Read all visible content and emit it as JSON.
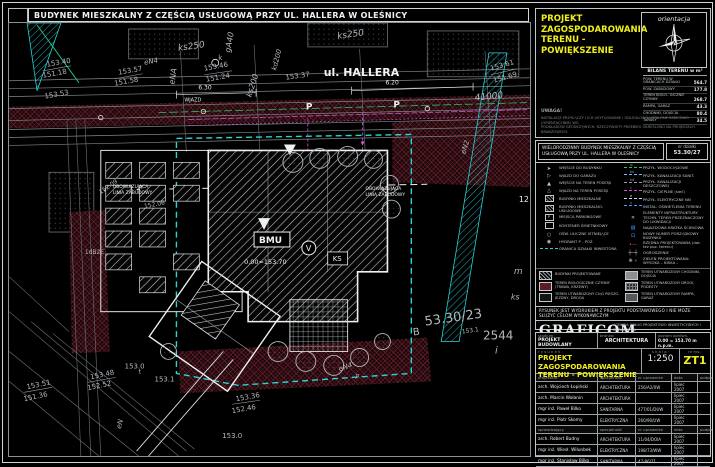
{
  "sheet_title": "BUDYNEK MIESZKALNY  Z CZĘŚCIĄ USŁUGOWĄ PRZY UL. HALLERA W OLEŚNICY",
  "colors": {
    "accent_yellow": "#f0ef1e",
    "boundary_cyan": "#27d3d3",
    "utility_magenta": "#cf53cf",
    "green_line": "#2abf6e",
    "maroon_hatch": "#6e2430"
  },
  "top_right": {
    "drawing_title_line1": "PROJEKT ZAGOSPODAROWANIA",
    "drawing_title_line2": "TERENU - POWIĘKSZENIE",
    "orientation_label": "orientacja",
    "balance": {
      "header": "BILANS TERENU w m²",
      "rows": [
        {
          "label": "POW. TERENU W GRANICACH DZIAŁKI",
          "value": "564.7"
        },
        {
          "label": "POW. ZABUDOWY",
          "value": "177.8"
        },
        {
          "label": "TEREN BIOLO- GICZNIE CZYNNY",
          "value": "268.7"
        },
        {
          "label": "RAMPA, GARAŻ",
          "value": "43.3"
        },
        {
          "label": "CHODNIKI, DOJŚCIA",
          "value": "80.4"
        },
        {
          "label": "TARASY",
          "value": "34.5"
        }
      ]
    },
    "note_title": "UWAGA!",
    "note_line1": "INSTALACJE PRZYŁĄCZY I ICH USYTUOWANIE I ODLEGŁOŚCI USTALONE SZKICOWO (ORIENTACYJNIE) WG",
    "note_line2": "PODKŁADÓW GEODEZYJNYCH. RZECZYWISTY PRZEBIEG OKREŚLONO NA PROJEKTACH BRANŻOWYCH."
  },
  "legend": {
    "header_line1": "WIELORODZINNY BUDYNEK MIESZKALNY Z CZĘŚCIĄ",
    "header_line2": "USŁUGOWĄ PRZY UL. HALLERA W OLEŚNICY",
    "plot_label": "nr działki",
    "plot_number": "53.30/27",
    "left_items": [
      {
        "icon": "arrow-filled",
        "label": "WEJŚCIE DO BUDYNKU"
      },
      {
        "icon": "arrow-open",
        "label": "WJAZD DO GARAŻU"
      },
      {
        "icon": "triangle-filled",
        "label": "WEJŚCIE NA TEREN POSESJI"
      },
      {
        "icon": "triangle-open",
        "label": "WJAZD NA TEREN POSESJI"
      },
      {
        "icon": "square-hatch",
        "label": "BUDYNKI MIESZKALNE"
      },
      {
        "icon": "square-hatch",
        "label": "BUDYNKI MIESZKALNO-USŁUGOWE"
      },
      {
        "icon": "square-p",
        "label": "MIEJSCA PARKINGOWE"
      },
      {
        "icon": "square-open",
        "label": "KONTENER ŚMIETNIKOWY"
      },
      {
        "icon": "circle-lamp",
        "label": "OŚW. ULICZNE ISTNIEJĄCE"
      },
      {
        "icon": "circle-hydrant",
        "label": "HYDRANT P - POŻ."
      },
      {
        "icon": "cyan-dash",
        "label": "GRANICA DZIAŁKI INWESTORA"
      }
    ],
    "right_items": [
      {
        "icon": "line",
        "color": "#2abf6e",
        "tag": "w",
        "label": "PRZYŁ. WODOCIĄGOWE"
      },
      {
        "icon": "line",
        "color": "#6fb7ff",
        "tag": "ks",
        "label": "PRZYŁ. KANALIZACJI SANIT."
      },
      {
        "icon": "line",
        "color": "#9aa0a4",
        "tag": "kd",
        "label": "PRZYŁ. KANALIZACJI DESZCZOWEJ"
      },
      {
        "icon": "line",
        "color": "#cf53cf",
        "tag": "c",
        "label": "PRZYŁ. CIEPLNE (sieć)"
      },
      {
        "icon": "line",
        "color": "#d6dadd",
        "tag": "e",
        "label": "PRZYŁ. ELEKTRYCZNE NN"
      },
      {
        "icon": "line",
        "color": "#3aa0ff",
        "tag": "o",
        "label": "INSTAL. OŚWIETLENIA TERENU"
      },
      {
        "icon": "x-mark",
        "label": "ELEMENTY INFRASTRUKTURY TECHN. TEREN PRZEZNACZONY DO LIKWIDACJI"
      },
      {
        "icon": "grate",
        "label": "NAJAZDOWA KRATKA ŚCIEKOWA"
      },
      {
        "icon": "number",
        "label": "NOWY NUMER PORZĄDKOWY BUDYNKU"
      },
      {
        "icon": "level-mark",
        "label": "RZĘDNA PROJEKTOWANA (dot. też poz. terenu)"
      },
      {
        "icon": "fence",
        "label": "OGRODZENIE"
      },
      {
        "icon": "greenery",
        "label": "ZIELEŃ PROJEKTOWANA:  WYSOKA –   NISKA –"
      }
    ],
    "swatches": [
      {
        "style": "hatch",
        "label": "BUDYNKI PROJEKTOWANE"
      },
      {
        "style": "grey",
        "label": "TEREN UTWARDZONY CHODNIKI, DOJŚCIA"
      },
      {
        "style": "maroon",
        "label": "TEREN BIOLOGICZNIE CZYNNY (TRAWA, KRZEWY)"
      },
      {
        "style": "checker",
        "label": "TEREN UTWARDZONY DROGI, PODESTY"
      },
      {
        "style": "outline",
        "label": "TEREN UTWARDZONY CIĄG PIESZO-JEZDNY, DROGA"
      },
      {
        "style": "dark",
        "label": "TEREN UTWARDZONY RAMPA, GARAŻ"
      }
    ],
    "disclaimer": "RYSUNEK JEST WYDRUKIEM Z PROJEKTU PODSTAWOWEGO I NIE MOŻE SŁUŻYĆ CELOM WYKONAWCZYM",
    "company": {
      "name": "GRAFICOM",
      "sub": "A R C H I T E K T U R A",
      "address_line1": "AGENCJA USŁUG PROJEKTOWO INWESTYCYJNYCH I DORADZTWA",
      "address_line2": "MARCIN WOŁANIN   50-430 WROCŁAW, UL. KRAKOWSKA 76",
      "address_line3": "TEL. 071 78-88-517, 501-783-382, FAX 071 78-88-501"
    }
  },
  "title_block": {
    "stadium_label": "stadium:",
    "stadium": "PROJEKT BUDOWLANY",
    "branza_label": "branża:",
    "branza": "ARCHITEKTURA",
    "level_label": "poziom porówn.",
    "level": "0.00 = 153.70 m n.p.m.",
    "rysunek_label": "r y s u n e k :",
    "drawing_line1": "PROJEKT ZAGOSPODAROWANIA",
    "drawing_line2": "TERENU - POWIĘKSZENIE",
    "scale_label": "s k a l a :",
    "scale": "1:250",
    "number_label": "nr rys.:",
    "number": "ZT1",
    "columns": {
      "designer": "projektant",
      "spec": "specjalność",
      "cert": "nr uprawnień",
      "date": "data",
      "sign": "podpis"
    },
    "checker_label": "sprawdzający",
    "designers": [
      {
        "name": "arch. Wojciech Łopiński",
        "spec": "ARCHITEKTURA",
        "cert": "256/A2/XW",
        "date": "lipiec 2007"
      },
      {
        "name": "arch. Marcin Wołanin",
        "spec": "ARCHITEKTURA",
        "cert": "",
        "date": "lipiec 2007"
      },
      {
        "name": "mgr inż. Paweł Bilko",
        "spec": "SANITARNA",
        "cert": "477/01/DUW",
        "date": "lipiec 2007"
      },
      {
        "name": "mgr inż. Piotr Skomy",
        "spec": "ELEKTRYCZNA",
        "cert": "260/90/UW",
        "date": "lipiec 2007"
      }
    ],
    "checkers": [
      {
        "name": "arch. Robert Budny",
        "spec": "ARCHITEKTURA",
        "cert": "11/04/DOIA",
        "date": "lipiec 2007"
      },
      {
        "name": "mgr inż. Wiesł. Wiłunbek",
        "spec": "ELEKTRYCZNA",
        "cert": "198/73/WW",
        "date": "lipiec 2007"
      },
      {
        "name": "mgr inż. Stanisław Bilko",
        "spec": "SANITARNA",
        "cert": "47-86/71",
        "date": "lipiec 2007"
      }
    ]
  },
  "map": {
    "labels": [
      {
        "t": "ks250",
        "x": 170,
        "y": 28,
        "s": 9,
        "r": -8,
        "i": 1
      },
      {
        "t": "ks250",
        "x": 330,
        "y": 16,
        "s": 9,
        "r": -8,
        "i": 1
      },
      {
        "t": "gA40",
        "x": 222,
        "y": 30,
        "s": 8,
        "r": -80,
        "i": 1
      },
      {
        "t": "kd200",
        "x": 268,
        "y": 48,
        "s": 7,
        "r": -75,
        "i": 1
      },
      {
        "t": "eNA",
        "x": 166,
        "y": 62,
        "s": 8,
        "r": -82,
        "i": 1
      },
      {
        "t": "ks200",
        "x": 243,
        "y": 75,
        "s": 8,
        "r": -72,
        "i": 1
      },
      {
        "t": "eN4",
        "x": 136,
        "y": 42,
        "s": 7,
        "r": -10,
        "i": 1
      },
      {
        "t": "153.40",
        "x": 38,
        "y": 44,
        "s": 7,
        "r": -10
      },
      {
        "t": "151.18",
        "x": 34,
        "y": 55,
        "s": 7,
        "r": -10
      },
      {
        "t": "153.57",
        "x": 110,
        "y": 52,
        "s": 7,
        "r": -10
      },
      {
        "t": "151.58",
        "x": 106,
        "y": 63,
        "s": 7,
        "r": -10
      },
      {
        "t": "153.46",
        "x": 196,
        "y": 48,
        "s": 7,
        "r": -10
      },
      {
        "t": "151.24",
        "x": 198,
        "y": 59,
        "s": 7,
        "r": -10
      },
      {
        "t": "153.53",
        "x": 36,
        "y": 76,
        "s": 7,
        "r": -10
      },
      {
        "t": "153.37",
        "x": 278,
        "y": 57,
        "s": 7,
        "r": -8
      },
      {
        "t": "6.30",
        "x": 190,
        "y": 67,
        "s": 6,
        "c": "#eef0f2"
      },
      {
        "t": "6.20",
        "x": 378,
        "y": 62,
        "s": 6,
        "c": "#eef0f2"
      },
      {
        "t": "ul. HALLERA",
        "x": 316,
        "y": 53,
        "s": 11,
        "c": "#f2f4f5",
        "b": 1
      },
      {
        "t": "41000",
        "x": 468,
        "y": 78,
        "s": 9,
        "r": -6,
        "i": 1
      },
      {
        "t": "153.61",
        "x": 484,
        "y": 48,
        "s": 7,
        "r": -16
      },
      {
        "t": "151.69",
        "x": 487,
        "y": 60,
        "s": 7,
        "r": -16
      },
      {
        "t": "P",
        "x": 298,
        "y": 87,
        "s": 9,
        "c": "#eef0f2",
        "b": 1
      },
      {
        "t": "P",
        "x": 386,
        "y": 85,
        "s": 9,
        "c": "#eef0f2",
        "b": 1
      },
      {
        "t": "WJAZD",
        "x": 176,
        "y": 79,
        "s": 5,
        "c": "#eef0f2"
      },
      {
        "t": "k",
        "x": 210,
        "y": 37,
        "s": 7
      },
      {
        "t": "eN2",
        "x": 458,
        "y": 132,
        "s": 7,
        "r": -72,
        "i": 1
      },
      {
        "t": "12",
        "x": 512,
        "y": 180,
        "s": 8,
        "c": "#eef0f2"
      },
      {
        "t": "m",
        "x": 507,
        "y": 252,
        "s": 9,
        "i": 1
      },
      {
        "t": "ks",
        "x": 504,
        "y": 278,
        "s": 8,
        "i": 1
      },
      {
        "t": "53.30/23",
        "x": 418,
        "y": 304,
        "s": 13,
        "r": -8
      },
      {
        "t": "B",
        "x": 406,
        "y": 314,
        "s": 10,
        "r": -8
      },
      {
        "t": "153.1",
        "x": 455,
        "y": 312,
        "s": 6,
        "r": -8
      },
      {
        "t": "2544",
        "x": 476,
        "y": 318,
        "s": 12
      },
      {
        "t": "i",
        "x": 488,
        "y": 332,
        "s": 10,
        "i": 1
      },
      {
        "t": "OBOWIĄZUJĄCA",
        "x": 104,
        "y": 166,
        "s": 4.5,
        "c": "#eef0f2"
      },
      {
        "t": "LINIA ZABUDOWY",
        "x": 104,
        "y": 172,
        "s": 4.5,
        "c": "#eef0f2"
      },
      {
        "t": "OBOWIĄZUJĄCA",
        "x": 358,
        "y": 168,
        "s": 4.5,
        "c": "#eef0f2"
      },
      {
        "t": "LINIA ZABUDOWY",
        "x": 358,
        "y": 174,
        "s": 4.5,
        "c": "#eef0f2"
      },
      {
        "t": "152.09",
        "x": 92,
        "y": 172,
        "s": 6,
        "r": -35
      },
      {
        "t": "152.06",
        "x": 136,
        "y": 186,
        "s": 6,
        "r": -10
      },
      {
        "t": "1dB2E",
        "x": 76,
        "y": 232,
        "s": 6
      },
      {
        "t": "BMU",
        "x": 251,
        "y": 221,
        "s": 9,
        "c": "#eef0f2",
        "b": 1
      },
      {
        "t": "0.00=153.70",
        "x": 236,
        "y": 242,
        "s": 6.5,
        "c": "#eef0f2"
      },
      {
        "t": "V",
        "x": 298,
        "y": 229,
        "s": 8,
        "c": "#eef0f2"
      },
      {
        "t": "KS",
        "x": 325,
        "y": 239,
        "s": 7,
        "c": "#eef0f2"
      },
      {
        "t": "153.48",
        "x": 82,
        "y": 358,
        "s": 7,
        "r": -12
      },
      {
        "t": "152.52",
        "x": 79,
        "y": 369,
        "s": 7,
        "r": -12
      },
      {
        "t": "153.51",
        "x": 18,
        "y": 368,
        "s": 7,
        "r": -12
      },
      {
        "t": "151.36",
        "x": 15,
        "y": 380,
        "s": 7,
        "r": -12
      },
      {
        "t": "153.36",
        "x": 228,
        "y": 380,
        "s": 7,
        "r": -10
      },
      {
        "t": "152.46",
        "x": 224,
        "y": 392,
        "s": 7,
        "r": -10
      },
      {
        "t": "153.0",
        "x": 116,
        "y": 347,
        "s": 7
      },
      {
        "t": "153.1",
        "x": 146,
        "y": 360,
        "s": 7
      },
      {
        "t": "t",
        "x": 130,
        "y": 352,
        "s": 6
      },
      {
        "t": "153.0",
        "x": 214,
        "y": 417,
        "s": 7
      },
      {
        "t": "eN",
        "x": 112,
        "y": 408,
        "s": 7,
        "r": -75,
        "i": 1
      },
      {
        "t": "eN4",
        "x": 332,
        "y": 350,
        "s": 7,
        "r": -20,
        "i": 1
      },
      {
        "t": "p",
        "x": 348,
        "y": 356,
        "s": 6,
        "i": 1
      }
    ]
  }
}
